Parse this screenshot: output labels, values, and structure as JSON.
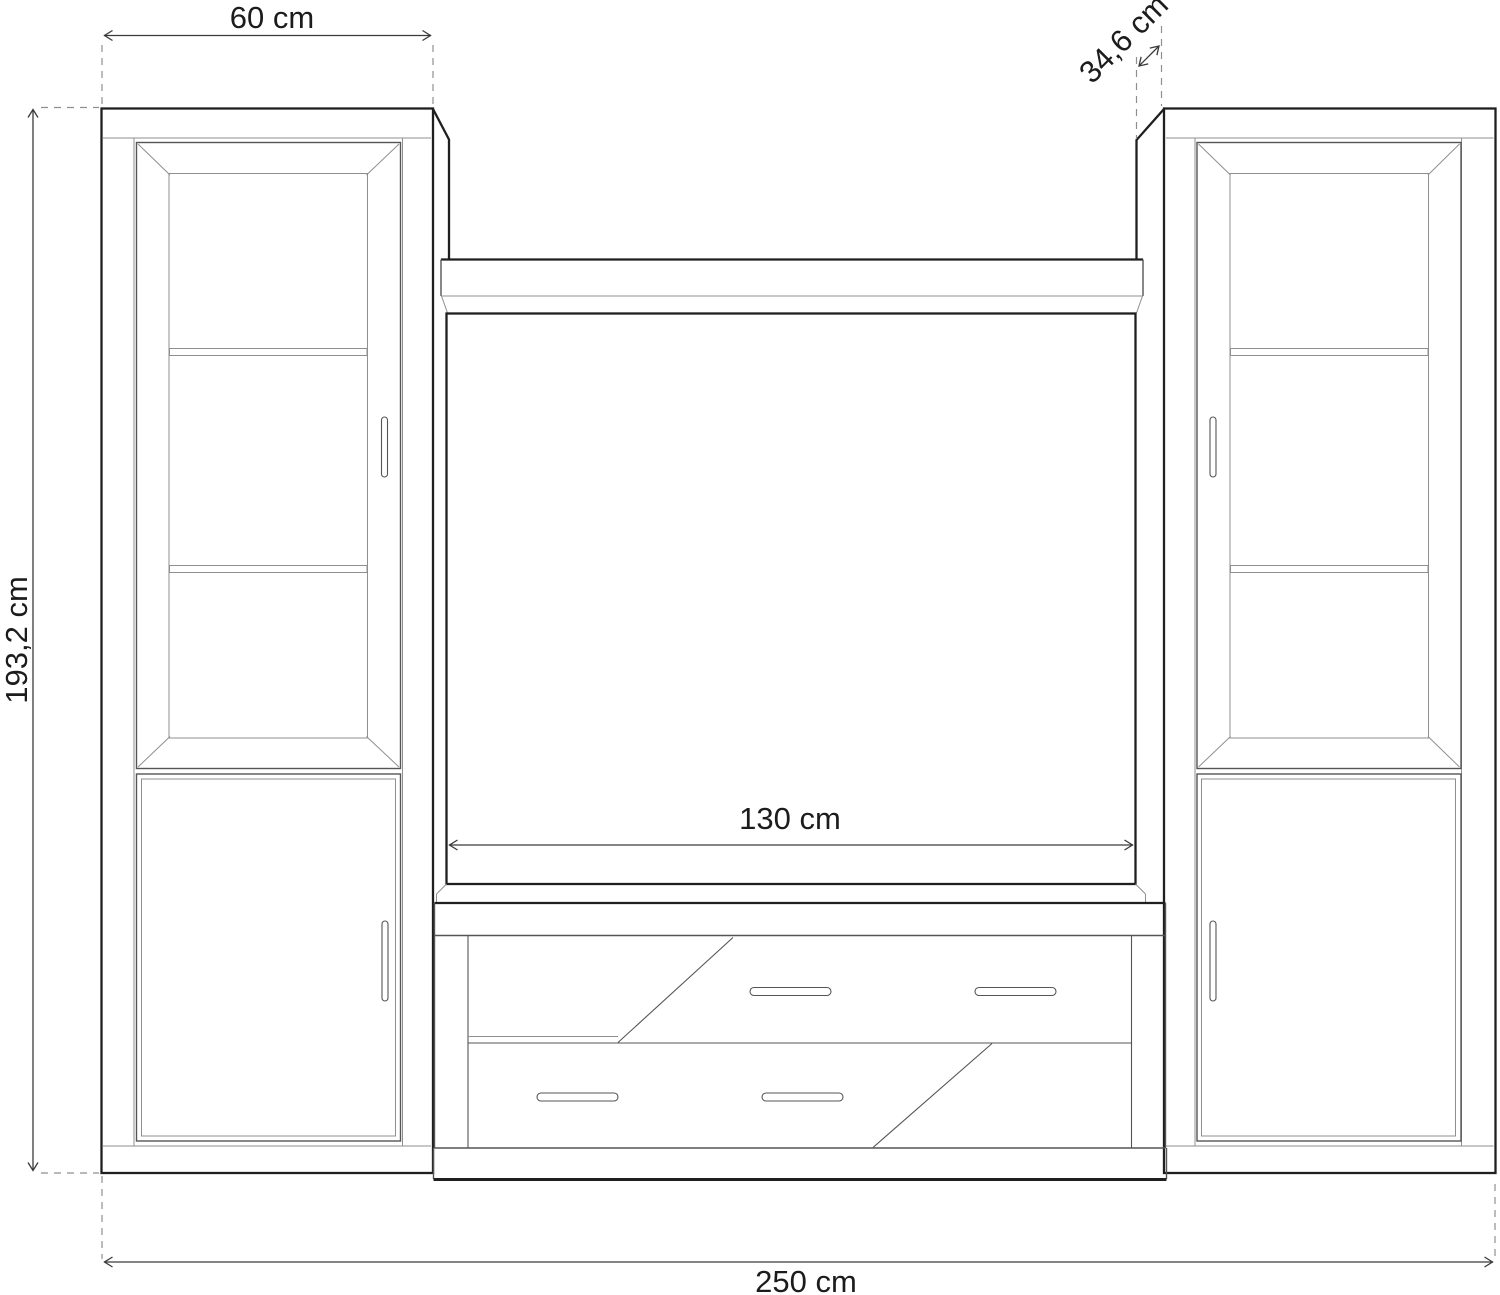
{
  "diagram": {
    "title": "TV wall unit technical dimension drawing",
    "unit_labels": {
      "left_width": "60 cm",
      "depth": "34,6 cm",
      "height": "193,2 cm",
      "center_width": "130 cm",
      "total_width": "250 cm"
    },
    "colors": {
      "background": "#ffffff",
      "outline": "#1f1f1f",
      "detail": "#555555",
      "thin": "#8f8f8f",
      "dimension": "#3a3a3a",
      "text": "#1c1c1c"
    }
  }
}
